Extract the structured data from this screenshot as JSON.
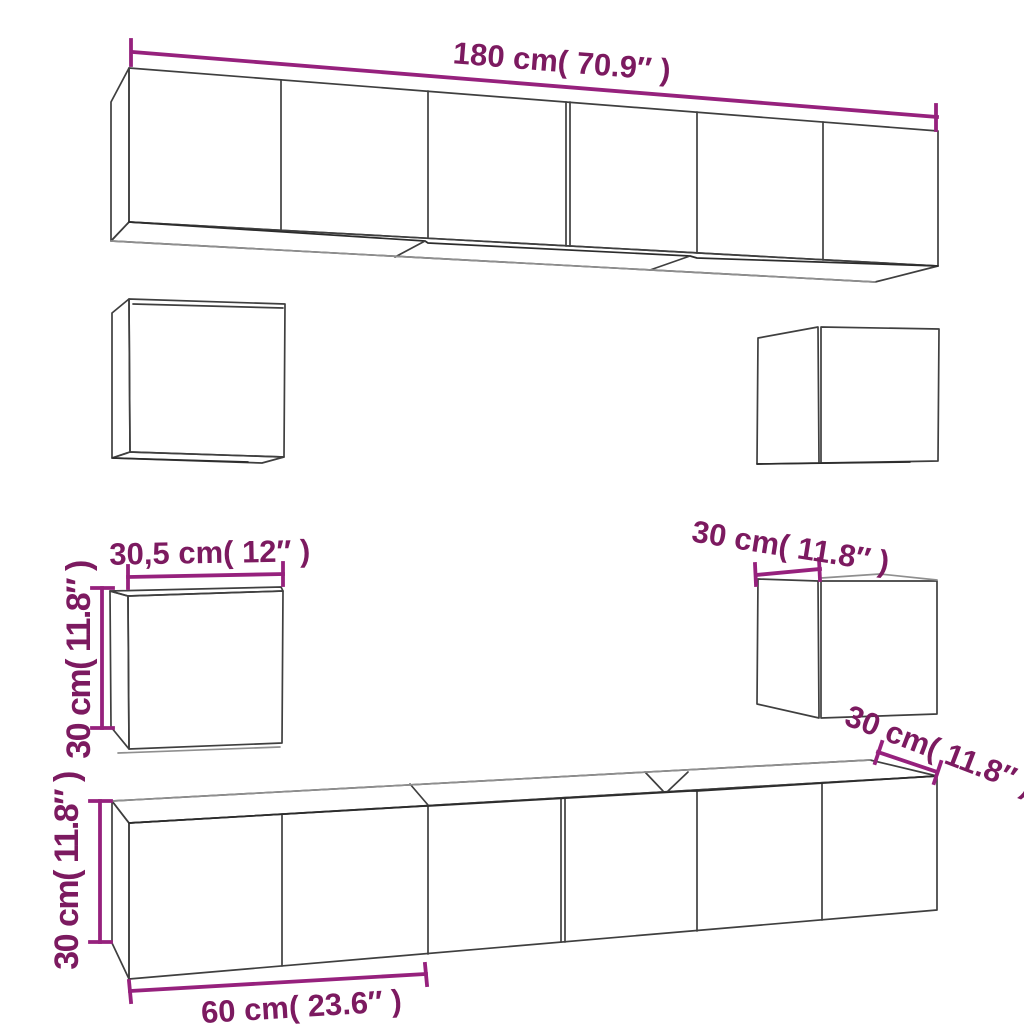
{
  "diagram": {
    "background": "#FFFFFF",
    "colors": {
      "dimension_line": "#96217D",
      "dimension_text": "#7C1A60",
      "edge": "#3F3F3F"
    },
    "labels": {
      "top_cabinet_width": "180 cm( 70.9″ )",
      "small_cabinet_width": "30,5 cm( 12″ )",
      "small_cabinet_height": "30 cm( 11.8″ )",
      "right_cabinet_depth": "30 cm( 11.8″ )",
      "bottom_cabinet_depth": "30 cm( 11.8″ )",
      "bottom_cabinet_height": "30 cm( 11.8″ )",
      "bottom_door_width": "60 cm( 23.6″ )"
    }
  }
}
